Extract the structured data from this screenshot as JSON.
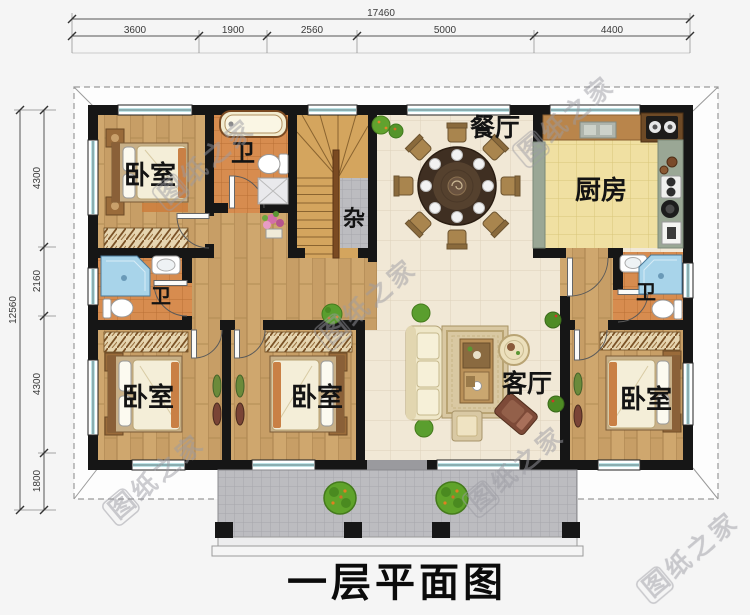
{
  "title": "一层平面图",
  "watermark_text": "图纸之家",
  "rooms": {
    "bedroom_tl": "卧室",
    "bath_top": "卫",
    "storage": "杂",
    "dining": "餐厅",
    "kitchen": "厨房",
    "bath_left": "卫",
    "bath_right": "卫",
    "bedroom_bl": "卧室",
    "bedroom_bm": "卧室",
    "bedroom_br": "卧室",
    "living": "客厅"
  },
  "dimensions": {
    "top": {
      "total": "17460",
      "segments": [
        "3600",
        "1900",
        "2560",
        "5000",
        "4400"
      ]
    },
    "left": {
      "total": "12560",
      "segments": [
        "4300",
        "2160",
        "4300",
        "1800"
      ]
    }
  },
  "colors": {
    "wall": "#161616",
    "window_glass": "#bfe3e6",
    "wood_floor": "#c79e66",
    "bath_tile": "#d78c4f",
    "kitchen_floor": "#f0e0a2",
    "living_floor": "#f1e8d6",
    "porch_tile": "#bcbcc0",
    "stair_wood": "#d4a55e",
    "roof_line": "#9a9a9a"
  }
}
